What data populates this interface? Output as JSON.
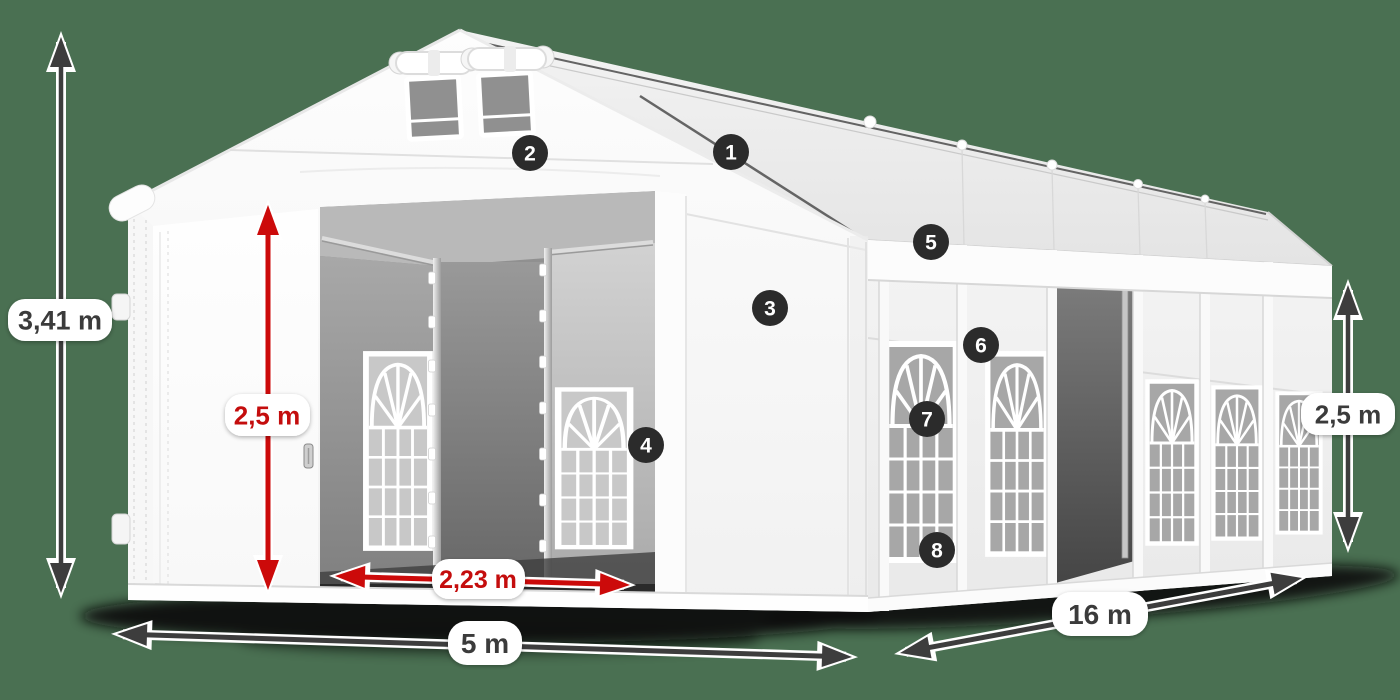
{
  "diagram": {
    "name": "party-tent-dimension-diagram",
    "background_color": "#4a7052",
    "labels": {
      "total_height": "3,41 m",
      "door_height": "2,5 m",
      "door_width": "2,23 m",
      "front_width": "5 m",
      "side_length": "16 m",
      "side_height": "2,5 m"
    },
    "callouts": [
      "1",
      "2",
      "3",
      "4",
      "5",
      "6",
      "7",
      "8"
    ],
    "colors": {
      "arrow_dark": "#3d3d3d",
      "arrow_red": "#cc0a0a",
      "label_text_dark": "#3a3a3a",
      "label_text_red": "#c40707",
      "pill_background": "#ffffff",
      "callout_background": "#2b2b2b",
      "callout_text": "#ffffff",
      "tent_canvas": "#ffffff",
      "ground_shadow": "#0a0a0a"
    }
  }
}
